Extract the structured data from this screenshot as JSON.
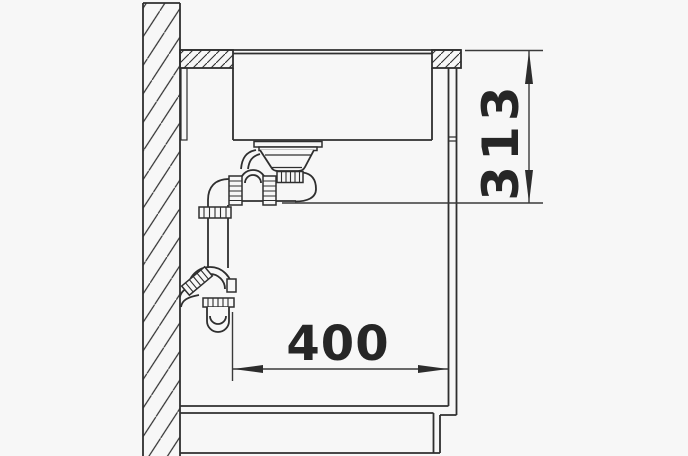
{
  "diagram": {
    "type": "technical-drawing",
    "description": "Side section installation drawing of an undermount kitchen sink with strainer, drain pipe and wall siphon inside a base cabinet",
    "dimensions": {
      "vertical": {
        "value": "313"
      },
      "horizontal": {
        "value": "400"
      }
    },
    "colors": {
      "background": "#f7f7f7",
      "line": "#2f2f2f",
      "dimension": "#3a3a3a",
      "text": "#262626"
    }
  }
}
